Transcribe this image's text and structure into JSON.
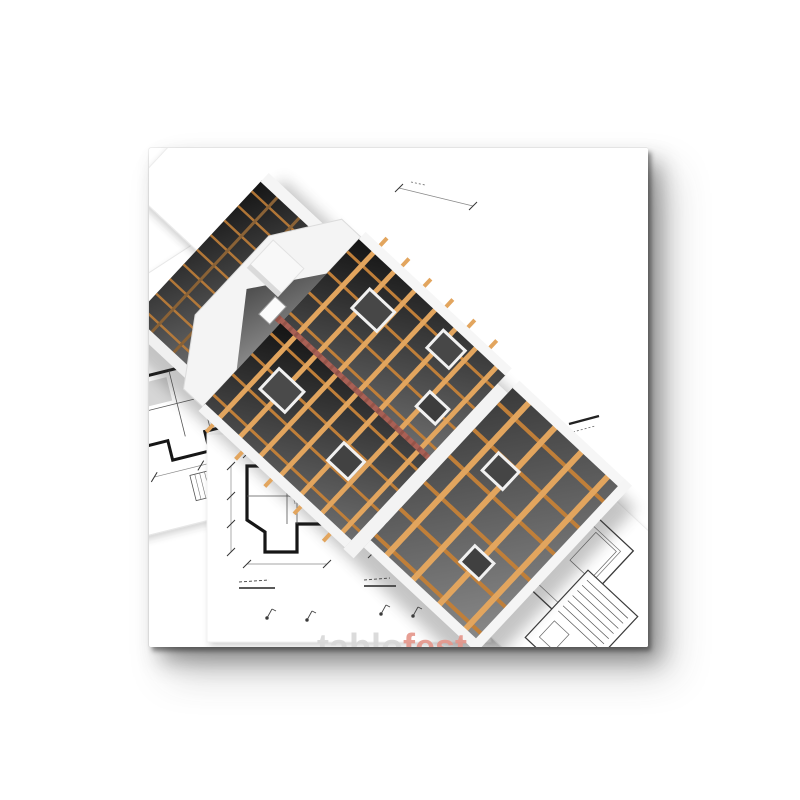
{
  "product": {
    "kind": "canvas-print-product-photo",
    "artwork_description": "3D render of a timber-framed house under construction standing on scattered architectural blueprint floor plans and stair details"
  },
  "watermark": {
    "part1": "tablo",
    "part2": "fest"
  },
  "icons": [
    {
      "name": "blueprint-floor-plan",
      "meaning": "architectural floor plan drawing"
    },
    {
      "name": "blueprint-stair-detail",
      "meaning": "staircase construction drawing"
    },
    {
      "name": "house-frame-model",
      "meaning": "3D wooden house frame"
    }
  ],
  "colors": {
    "page_bg": "#ffffff",
    "canvas_bg": "#ffffff",
    "beam_light": "#e2a55e",
    "beam_dark": "#c07f39",
    "beam_shadow": "#8a6236",
    "ridge_red": "#a96055",
    "interior_dark": "#141414",
    "interior_light": "#6e6e6e",
    "blueprint_line": "#555555",
    "blueprint_wall": "#161616",
    "paper_edge": "#e7e7e7",
    "watermark_gray": "#d8d8d8",
    "watermark_red": "#e5978c"
  }
}
